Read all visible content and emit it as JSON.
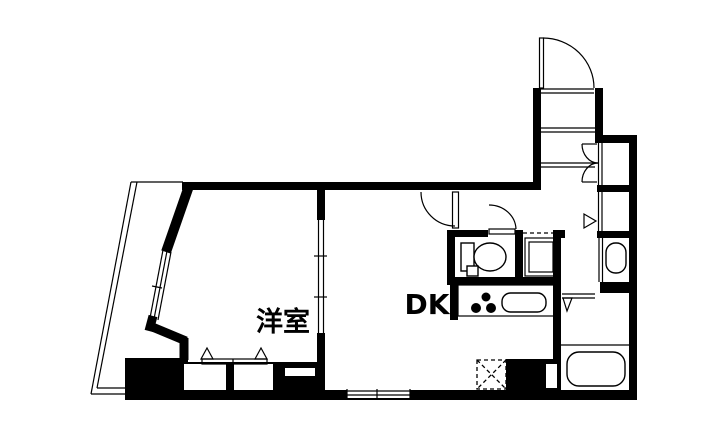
{
  "title": "apartment-floor-plan",
  "labels": {
    "western_room": "洋室",
    "dining_kitchen": "DK"
  },
  "colors": {
    "wall": "#000000",
    "background": "#ffffff"
  },
  "fixtures": [
    "entrance-door",
    "hall-closet-bifold-door",
    "hall-closet-folding-door",
    "toilet",
    "washing-machine-pan",
    "washbasin",
    "bathtub",
    "kitchen-counter",
    "stove-burners",
    "kitchen-sink",
    "refrigerator-space",
    "sliding-door",
    "balcony"
  ]
}
